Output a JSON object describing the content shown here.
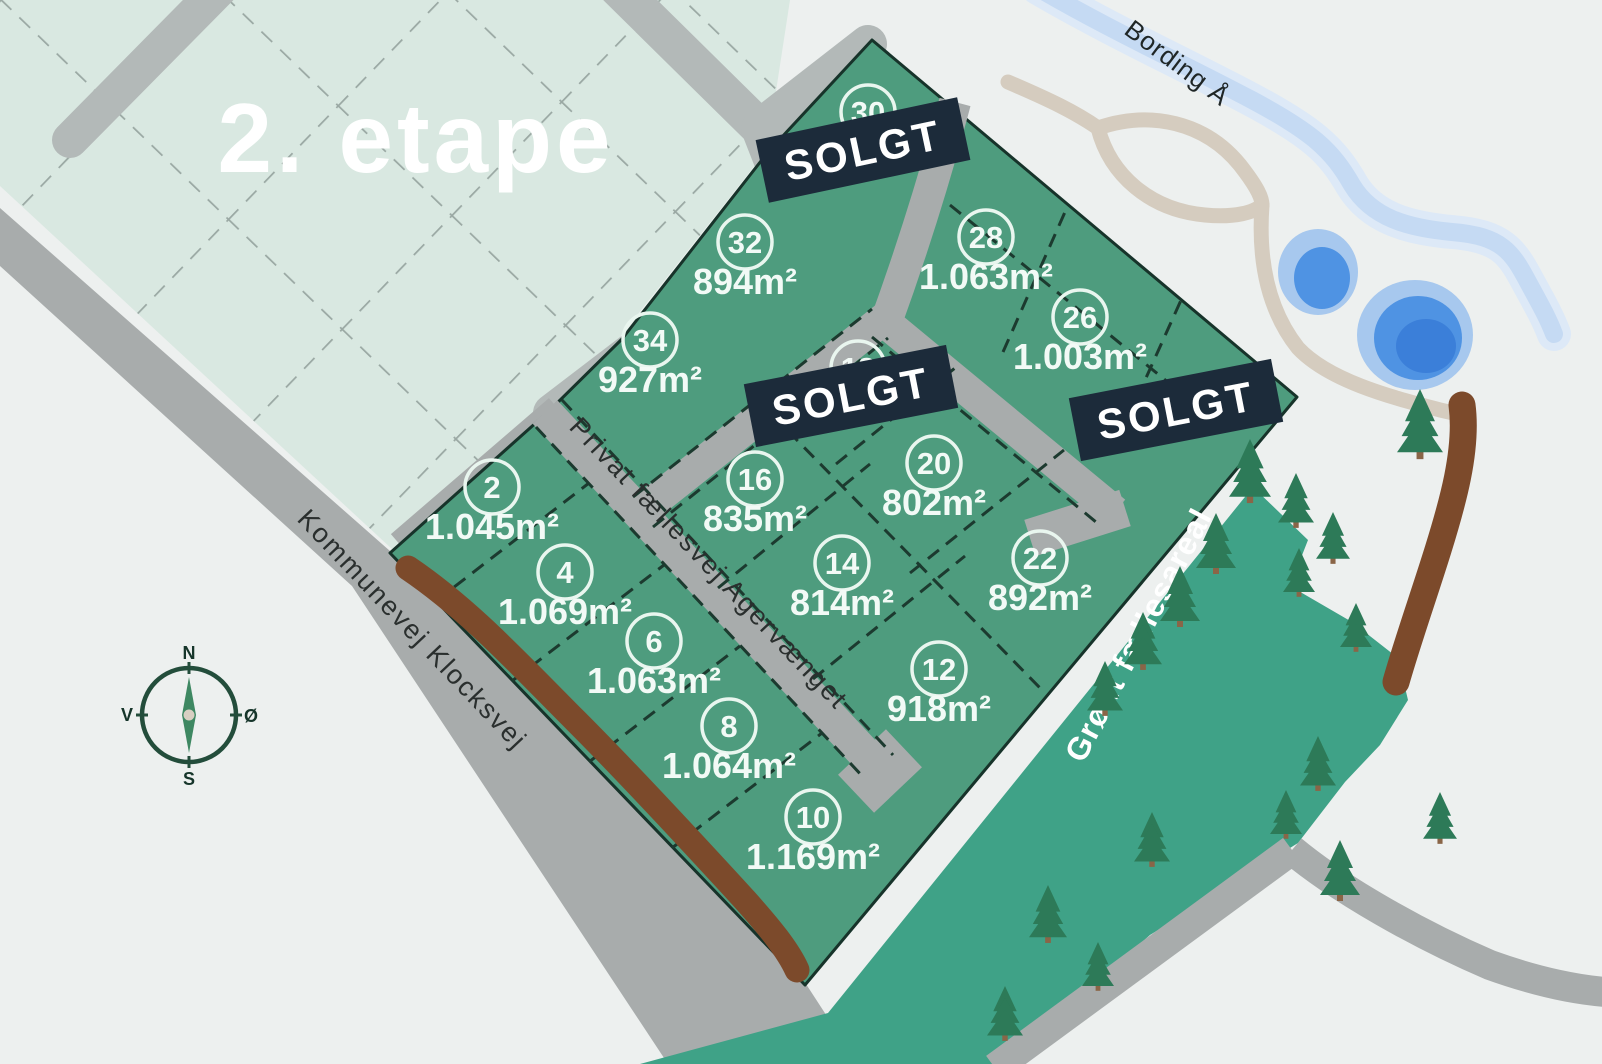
{
  "map": {
    "phase_label": "2. etape",
    "sold_label": "SOLGT",
    "river_label": "Bording Å",
    "common_area_label": "Grønt fællesareal",
    "roads": {
      "municipal": "Kommunevej Klocksvej",
      "private": "Privat fællesvej Agervænget"
    },
    "compass": {
      "north": "N",
      "south": "S",
      "west": "V",
      "east": "Ø"
    },
    "plots": [
      {
        "number": "2",
        "area": "1.045m²",
        "status": "available"
      },
      {
        "number": "4",
        "area": "1.069m²",
        "status": "available"
      },
      {
        "number": "6",
        "area": "1.063m²",
        "status": "available"
      },
      {
        "number": "8",
        "area": "1.064m²",
        "status": "available"
      },
      {
        "number": "10",
        "area": "1.169m²",
        "status": "available"
      },
      {
        "number": "12",
        "area": "918m²",
        "status": "available"
      },
      {
        "number": "14",
        "area": "814m²",
        "status": "available"
      },
      {
        "number": "16",
        "area": "835m²",
        "status": "available"
      },
      {
        "number": "20",
        "area": "802m²",
        "status": "available"
      },
      {
        "number": "22",
        "area": "892m²",
        "status": "available"
      },
      {
        "number": "26",
        "area": "1.003m²",
        "status": "available"
      },
      {
        "number": "28",
        "area": "1.063m²",
        "status": "available"
      },
      {
        "number": "32",
        "area": "894m²",
        "status": "available"
      },
      {
        "number": "34",
        "area": "927m²",
        "status": "available"
      },
      {
        "number": "30",
        "area": "",
        "status": "sold"
      },
      {
        "number": "18",
        "area": "",
        "status": "sold"
      },
      {
        "number": "24",
        "area": "",
        "status": "sold"
      }
    ],
    "colors": {
      "plot_green": "#4e9c7e",
      "phase2_green": "#d9e8e1",
      "common_green": "#3fa287",
      "road_gray": "#a8acac",
      "sold_navy": "#1c2b3a",
      "water_blue": "#4f93e3",
      "hedge_brown": "#7c4a2b",
      "background": "#edf0ef"
    }
  }
}
